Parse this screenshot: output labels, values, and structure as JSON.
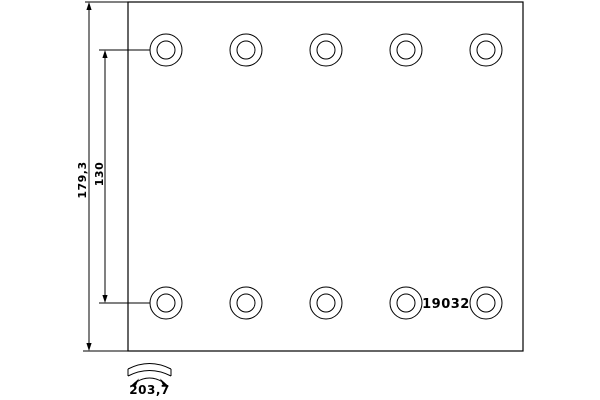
{
  "drawing": {
    "type": "technical-drawing",
    "part_number": "19032",
    "dimensions": {
      "height_label": "179,3",
      "hole_row_spacing_label": "130",
      "arc_width_label": "203,7"
    },
    "colors": {
      "line": "#000000",
      "background": "#ffffff"
    },
    "plate": {
      "x": 128,
      "y": 2,
      "width": 395,
      "height": 349
    },
    "holes": {
      "count": 10,
      "centers_x": [
        166,
        246,
        326,
        406,
        486
      ],
      "row_y": [
        50,
        303
      ],
      "outer_radius": 16,
      "inner_radius": 9
    }
  }
}
